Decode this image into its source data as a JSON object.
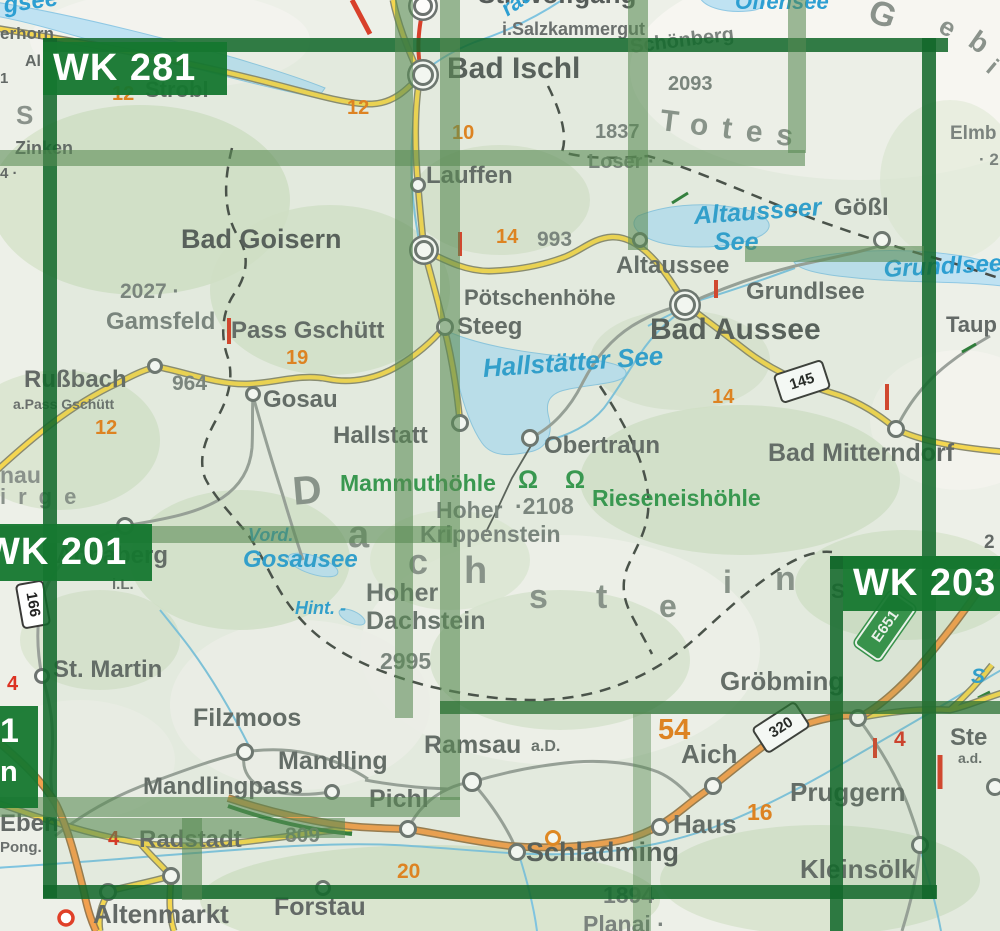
{
  "colors": {
    "sheet_green": "#157731",
    "overlay_green": "#588a52",
    "road_yellow": "#f4d650",
    "road_orange": "#f2a04e",
    "water_blue": "#2d9fd2",
    "lake_fill": "#bfe2f2",
    "town_gray": "#636966",
    "route_orange": "#e6801c",
    "mark_red": "#dc3222",
    "cave_green": "#35974e"
  },
  "sheets": [
    {
      "t": "WK 281"
    },
    {
      "t": "WK 201"
    },
    {
      "t": "WK 203"
    }
  ],
  "partial_sheet": {
    "l1": "1",
    "l2": "n"
  },
  "labels": [
    {
      "n": "wolfgangsee-frag",
      "t": "gsee",
      "x": 2,
      "y": -6,
      "s": 24,
      "c": "water",
      "r": -8
    },
    {
      "n": "st-wolfgang-frag",
      "t": "St. Wolfgang",
      "x": 478,
      "y": -19,
      "s": 26,
      "c": "town-lg"
    },
    {
      "n": "salzkammergut",
      "t": "i.Salzkammergut",
      "x": 502,
      "y": 20,
      "s": 18,
      "c": "small"
    },
    {
      "n": "zwoelferhorn-frag",
      "t": "erhorn",
      "x": 0,
      "y": 25,
      "s": 17,
      "c": "town"
    },
    {
      "n": "frag-al",
      "t": "Al",
      "x": 25,
      "y": 54,
      "s": 16,
      "c": "town"
    },
    {
      "n": "frag-1",
      "t": "1",
      "x": 0,
      "y": 71,
      "s": 15,
      "c": "town"
    },
    {
      "n": "frag-s",
      "t": "S",
      "x": 16,
      "y": 102,
      "s": 26,
      "c": "region"
    },
    {
      "n": "zinken",
      "t": "Zinken",
      "x": 15,
      "y": 139,
      "s": 18,
      "c": "town"
    },
    {
      "n": "frag-4",
      "t": "4 ·",
      "x": 0,
      "y": 166,
      "s": 15,
      "c": "town"
    },
    {
      "n": "route-12-strobl",
      "t": "12",
      "x": 112,
      "y": 84,
      "s": 20,
      "c": "route"
    },
    {
      "n": "strobl",
      "t": "Strobl",
      "x": 145,
      "y": 79,
      "s": 22,
      "c": "town"
    },
    {
      "n": "route-12-ischl",
      "t": "12",
      "x": 347,
      "y": 98,
      "s": 20,
      "c": "route"
    },
    {
      "n": "bad-ischl",
      "t": "Bad Ischl",
      "x": 447,
      "y": 54,
      "s": 30,
      "c": "town-lg"
    },
    {
      "n": "traun-frag",
      "t": "raun",
      "x": 497,
      "y": 2,
      "s": 22,
      "c": "water",
      "r": -35
    },
    {
      "n": "offensee",
      "t": "Offensee",
      "x": 735,
      "y": -9,
      "s": 22,
      "c": "water"
    },
    {
      "n": "schoenberg",
      "t": "Schönberg",
      "x": 629,
      "y": 37,
      "s": 20,
      "c": "peak",
      "r": -7
    },
    {
      "n": "schoenberg-elev",
      "t": "2093",
      "x": 668,
      "y": 74,
      "s": 20,
      "c": "peak"
    },
    {
      "n": "loser-elev",
      "t": "1837",
      "x": 595,
      "y": 122,
      "s": 20,
      "c": "peak"
    },
    {
      "n": "loser",
      "t": "Loser ·",
      "x": 588,
      "y": 152,
      "s": 20,
      "c": "peak"
    },
    {
      "n": "totes",
      "t": "Totes",
      "x": 662,
      "y": 106,
      "s": 30,
      "c": "region",
      "r": 7,
      "ls": 14
    },
    {
      "n": "gebirge-g",
      "t": "G",
      "x": 876,
      "y": -6,
      "s": 34,
      "c": "region",
      "r": 20
    },
    {
      "n": "gebirge-e",
      "t": "e",
      "x": 948,
      "y": 12,
      "s": 26,
      "c": "region",
      "r": 30
    },
    {
      "n": "gebirge-b",
      "t": "b",
      "x": 980,
      "y": 26,
      "s": 28,
      "c": "region",
      "r": 35
    },
    {
      "n": "gebirge-i",
      "t": "i",
      "x": 997,
      "y": 56,
      "s": 24,
      "c": "region",
      "r": 40
    },
    {
      "n": "elmberg-frag",
      "t": "Elmb",
      "x": 950,
      "y": 124,
      "s": 19,
      "c": "peak"
    },
    {
      "n": "elm-elev-frag",
      "t": "· 2",
      "x": 979,
      "y": 151,
      "s": 17,
      "c": "peak"
    },
    {
      "n": "route-10",
      "t": "10",
      "x": 452,
      "y": 123,
      "s": 20,
      "c": "route"
    },
    {
      "n": "lauffen",
      "t": "Lauffen",
      "x": 426,
      "y": 164,
      "s": 24,
      "c": "town"
    },
    {
      "n": "bad-goisern",
      "t": "Bad Goisern",
      "x": 181,
      "y": 226,
      "s": 27,
      "c": "town-lg"
    },
    {
      "n": "route-14-a",
      "t": "14",
      "x": 496,
      "y": 227,
      "s": 20,
      "c": "route"
    },
    {
      "n": "poetschen-elev",
      "t": "993",
      "x": 537,
      "y": 229,
      "s": 21,
      "c": "peak"
    },
    {
      "n": "altausseer-see-1",
      "t": "Altausseer",
      "x": 693,
      "y": 204,
      "s": 25,
      "c": "water",
      "r": -4
    },
    {
      "n": "altausseer-see-2",
      "t": "See",
      "x": 714,
      "y": 230,
      "s": 25,
      "c": "water"
    },
    {
      "n": "goessl",
      "t": "Gößl",
      "x": 834,
      "y": 196,
      "s": 24,
      "c": "town"
    },
    {
      "n": "poetschenhoehe",
      "t": "Pötschenhöhe",
      "x": 464,
      "y": 287,
      "s": 22,
      "c": "town"
    },
    {
      "n": "steeg",
      "t": "Steeg",
      "x": 457,
      "y": 315,
      "s": 24,
      "c": "town"
    },
    {
      "n": "altaussee",
      "t": "Altaussee",
      "x": 616,
      "y": 254,
      "s": 24,
      "c": "town"
    },
    {
      "n": "grundlsee-town",
      "t": "Grundlsee",
      "x": 746,
      "y": 280,
      "s": 24,
      "c": "town"
    },
    {
      "n": "grundlsee-lake",
      "t": "Grundlsee",
      "x": 883,
      "y": 258,
      "s": 24,
      "c": "water",
      "r": -3
    },
    {
      "n": "bad-aussee",
      "t": "Bad Aussee",
      "x": 650,
      "y": 315,
      "s": 30,
      "c": "town-lg"
    },
    {
      "n": "tauplitz-frag",
      "t": "Taup",
      "x": 946,
      "y": 314,
      "s": 22,
      "c": "town"
    },
    {
      "n": "gamsfeld-elev",
      "t": "2027 ·",
      "x": 120,
      "y": 281,
      "s": 21,
      "c": "peak"
    },
    {
      "n": "gamsfeld",
      "t": "Gamsfeld",
      "x": 106,
      "y": 310,
      "s": 24,
      "c": "peak"
    },
    {
      "n": "pass-gschuett",
      "t": "Pass Gschütt",
      "x": 231,
      "y": 319,
      "s": 24,
      "c": "town"
    },
    {
      "n": "route-19",
      "t": "19",
      "x": 286,
      "y": 348,
      "s": 20,
      "c": "route"
    },
    {
      "n": "russbach",
      "t": "Rußbach",
      "x": 24,
      "y": 368,
      "s": 24,
      "c": "town"
    },
    {
      "n": "russbach-elev",
      "t": "964",
      "x": 172,
      "y": 373,
      "s": 21,
      "c": "peak"
    },
    {
      "n": "a-pass-gschuett",
      "t": "a.Pass Gschütt",
      "x": 13,
      "y": 397,
      "s": 14,
      "c": "small"
    },
    {
      "n": "route-12-gschuett",
      "t": "12",
      "x": 95,
      "y": 418,
      "s": 20,
      "c": "route"
    },
    {
      "n": "gosau",
      "t": "Gosau",
      "x": 263,
      "y": 388,
      "s": 24,
      "c": "town"
    },
    {
      "n": "hallstaetter-see",
      "t": "Hallstätter See",
      "x": 482,
      "y": 355,
      "s": 26,
      "c": "water",
      "r": -4
    },
    {
      "n": "hallstatt",
      "t": "Hallstatt",
      "x": 333,
      "y": 424,
      "s": 24,
      "c": "town"
    },
    {
      "n": "obertraun",
      "t": "Obertraun",
      "x": 544,
      "y": 434,
      "s": 24,
      "c": "town"
    },
    {
      "n": "bad-mitterndorf",
      "t": "Bad Mitterndorf",
      "x": 768,
      "y": 441,
      "s": 25,
      "c": "town"
    },
    {
      "n": "route-14-b",
      "t": "14",
      "x": 712,
      "y": 387,
      "s": 20,
      "c": "route"
    },
    {
      "n": "mammuthoehle",
      "t": "Mammuthöhle",
      "x": 340,
      "y": 472,
      "s": 23,
      "c": "cave"
    },
    {
      "n": "cave-symbols",
      "t": "Ω Ω",
      "x": 518,
      "y": 468,
      "s": 25,
      "c": "cave",
      "ls": 10
    },
    {
      "n": "rieseneishoehle",
      "t": "Rieseneishöhle",
      "x": 592,
      "y": 487,
      "s": 23,
      "c": "cave"
    },
    {
      "n": "krippenstein-hoher",
      "t": "Hoher",
      "x": 436,
      "y": 499,
      "s": 23,
      "c": "peak"
    },
    {
      "n": "krippenstein-elev",
      "t": "·2108",
      "x": 515,
      "y": 495,
      "s": 23,
      "c": "peak"
    },
    {
      "n": "krippenstein",
      "t": "Krippenstein",
      "x": 420,
      "y": 523,
      "s": 23,
      "c": "peak"
    },
    {
      "n": "frag-nau",
      "t": "nau",
      "x": 0,
      "y": 464,
      "s": 23,
      "c": "region"
    },
    {
      "n": "frag-irge",
      "t": "irge",
      "x": 0,
      "y": 486,
      "s": 22,
      "c": "region",
      "ls": 12
    },
    {
      "n": "gosausee-vord",
      "t": "Vord.",
      "x": 248,
      "y": 526,
      "s": 18,
      "c": "water"
    },
    {
      "n": "gosausee",
      "t": "Gosausee",
      "x": 243,
      "y": 548,
      "s": 24,
      "c": "water"
    },
    {
      "n": "gosausee-hint",
      "t": "Hint. -",
      "x": 295,
      "y": 599,
      "s": 18,
      "c": "water"
    },
    {
      "n": "annaberg",
      "t": "Annaberg",
      "x": 56,
      "y": 544,
      "s": 24,
      "c": "town"
    },
    {
      "n": "annaberg-il",
      "t": "i.L.",
      "x": 112,
      "y": 577,
      "s": 15,
      "c": "small"
    },
    {
      "n": "dachstein-d",
      "t": "D",
      "x": 291,
      "y": 472,
      "s": 40,
      "c": "region",
      "r": -5
    },
    {
      "n": "dachstein-a",
      "t": "a",
      "x": 348,
      "y": 516,
      "s": 38,
      "c": "region"
    },
    {
      "n": "dachstein-c",
      "t": "c",
      "x": 408,
      "y": 544,
      "s": 36,
      "c": "region"
    },
    {
      "n": "dachstein-h",
      "t": "h",
      "x": 464,
      "y": 552,
      "s": 38,
      "c": "region"
    },
    {
      "n": "dachstein-s",
      "t": "s",
      "x": 529,
      "y": 580,
      "s": 34,
      "c": "region"
    },
    {
      "n": "dachstein-t",
      "t": "t",
      "x": 596,
      "y": 580,
      "s": 34,
      "c": "region"
    },
    {
      "n": "dachstein-e",
      "t": "e",
      "x": 659,
      "y": 590,
      "s": 32,
      "c": "region"
    },
    {
      "n": "dachstein-i",
      "t": "i",
      "x": 723,
      "y": 566,
      "s": 32,
      "c": "region"
    },
    {
      "n": "dachstein-n",
      "t": "n",
      "x": 775,
      "y": 562,
      "s": 34,
      "c": "region"
    },
    {
      "n": "hoher-dachstein-1",
      "t": "Hoher",
      "x": 366,
      "y": 581,
      "s": 25,
      "c": "peak-b"
    },
    {
      "n": "hoher-dachstein-2",
      "t": "Dachstein",
      "x": 366,
      "y": 609,
      "s": 25,
      "c": "peak-b"
    },
    {
      "n": "dachstein-elev",
      "t": "2995",
      "x": 380,
      "y": 650,
      "s": 23,
      "c": "peak"
    },
    {
      "n": "st-martin",
      "t": "St. Martin",
      "x": 53,
      "y": 658,
      "s": 24,
      "c": "town"
    },
    {
      "n": "red-4-a",
      "t": "4",
      "x": 7,
      "y": 674,
      "s": 20,
      "c": "red"
    },
    {
      "n": "filzmoos",
      "t": "Filzmoos",
      "x": 193,
      "y": 706,
      "s": 25,
      "c": "town"
    },
    {
      "n": "groebming",
      "t": "Gröbming",
      "x": 720,
      "y": 668,
      "s": 26,
      "c": "town"
    },
    {
      "n": "route-54",
      "t": "54",
      "x": 658,
      "y": 716,
      "s": 29,
      "c": "route"
    },
    {
      "n": "frag-2",
      "t": "2",
      "x": 984,
      "y": 533,
      "s": 19,
      "c": "town"
    },
    {
      "n": "frag-s2",
      "t": "S",
      "x": 831,
      "y": 581,
      "s": 21,
      "c": "town"
    },
    {
      "n": "mandling",
      "t": "Mandling",
      "x": 278,
      "y": 749,
      "s": 25,
      "c": "town"
    },
    {
      "n": "mandlingpass",
      "t": "Mandlingpass",
      "x": 143,
      "y": 775,
      "s": 24,
      "c": "town"
    },
    {
      "n": "pichl",
      "t": "Pichl",
      "x": 369,
      "y": 787,
      "s": 25,
      "c": "town"
    },
    {
      "n": "ramsau",
      "t": "Ramsau",
      "x": 424,
      "y": 733,
      "s": 25,
      "c": "town"
    },
    {
      "n": "ramsau-ad",
      "t": "a.D.",
      "x": 531,
      "y": 739,
      "s": 16,
      "c": "small"
    },
    {
      "n": "radstadt-elev",
      "t": "809",
      "x": 285,
      "y": 825,
      "s": 21,
      "c": "peak"
    },
    {
      "n": "radstadt",
      "t": "Radstadt",
      "x": 139,
      "y": 828,
      "s": 24,
      "c": "town"
    },
    {
      "n": "red-4-b",
      "t": "4",
      "x": 108,
      "y": 829,
      "s": 20,
      "c": "red"
    },
    {
      "n": "eben",
      "t": "Eben",
      "x": 0,
      "y": 812,
      "s": 24,
      "c": "town"
    },
    {
      "n": "eben-pongau",
      "t": "Pong.",
      "x": 0,
      "y": 840,
      "s": 15,
      "c": "small"
    },
    {
      "n": "altenmarkt",
      "t": "Altenmarkt",
      "x": 93,
      "y": 901,
      "s": 26,
      "c": "town"
    },
    {
      "n": "forstau",
      "t": "Forstau",
      "x": 274,
      "y": 895,
      "s": 25,
      "c": "town"
    },
    {
      "n": "route-20",
      "t": "20",
      "x": 397,
      "y": 861,
      "s": 21,
      "c": "route"
    },
    {
      "n": "schladming",
      "t": "Schladming",
      "x": 526,
      "y": 839,
      "s": 27,
      "c": "town-lg"
    },
    {
      "n": "planai-elev",
      "t": "1894",
      "x": 603,
      "y": 884,
      "s": 23,
      "c": "peak"
    },
    {
      "n": "planai",
      "t": "Planai ·",
      "x": 583,
      "y": 913,
      "s": 23,
      "c": "peak"
    },
    {
      "n": "haus",
      "t": "Haus",
      "x": 673,
      "y": 811,
      "s": 26,
      "c": "town"
    },
    {
      "n": "aich",
      "t": "Aich",
      "x": 681,
      "y": 741,
      "s": 26,
      "c": "town"
    },
    {
      "n": "route-16",
      "t": "16",
      "x": 747,
      "y": 801,
      "s": 23,
      "c": "route"
    },
    {
      "n": "pruggern",
      "t": "Pruggern",
      "x": 790,
      "y": 779,
      "s": 26,
      "c": "town"
    },
    {
      "n": "kleinsoelk",
      "t": "Kleinsölk",
      "x": 800,
      "y": 856,
      "s": 26,
      "c": "town"
    },
    {
      "n": "stein-frag",
      "t": "Ste",
      "x": 950,
      "y": 726,
      "s": 24,
      "c": "town"
    },
    {
      "n": "stein-ad",
      "t": "a.d.",
      "x": 958,
      "y": 751,
      "s": 14,
      "c": "small"
    },
    {
      "n": "red-4-c",
      "t": "4",
      "x": 894,
      "y": 729,
      "s": 21,
      "c": "red"
    },
    {
      "n": "water-s-frag",
      "t": "S",
      "x": 971,
      "y": 666,
      "s": 21,
      "c": "water"
    }
  ],
  "markers": [
    {
      "n": "st-wolfgang",
      "x": 423,
      "y": 6,
      "r": 10,
      "k": "double"
    },
    {
      "n": "bad-ischl",
      "x": 423,
      "y": 75,
      "r": 11,
      "k": "double"
    },
    {
      "n": "lauffen",
      "x": 418,
      "y": 185,
      "r": 8,
      "k": "town"
    },
    {
      "n": "bad-goisern",
      "x": 424,
      "y": 250,
      "r": 10,
      "k": "double"
    },
    {
      "n": "goessl",
      "x": 882,
      "y": 240,
      "r": 9,
      "k": "town"
    },
    {
      "n": "altaussee",
      "x": 640,
      "y": 240,
      "r": 8,
      "k": "town"
    },
    {
      "n": "bad-aussee",
      "x": 685,
      "y": 305,
      "r": 11,
      "k": "double"
    },
    {
      "n": "steeg",
      "x": 445,
      "y": 327,
      "r": 9,
      "k": "town"
    },
    {
      "n": "hallstatt",
      "x": 460,
      "y": 423,
      "r": 9,
      "k": "town"
    },
    {
      "n": "obertraun",
      "x": 530,
      "y": 438,
      "r": 9,
      "k": "town"
    },
    {
      "n": "bad-mitterndorf",
      "x": 896,
      "y": 429,
      "r": 9,
      "k": "town"
    },
    {
      "n": "gosau",
      "x": 253,
      "y": 394,
      "r": 8,
      "k": "town"
    },
    {
      "n": "russbach",
      "x": 155,
      "y": 366,
      "r": 8,
      "k": "town"
    },
    {
      "n": "annaberg",
      "x": 125,
      "y": 526,
      "r": 9,
      "k": "town"
    },
    {
      "n": "st-martin",
      "x": 42,
      "y": 676,
      "r": 8,
      "k": "town"
    },
    {
      "n": "filzmoos",
      "x": 245,
      "y": 752,
      "r": 9,
      "k": "town"
    },
    {
      "n": "mandlingpass",
      "x": 332,
      "y": 792,
      "r": 8,
      "k": "town"
    },
    {
      "n": "radstadt",
      "x": 171,
      "y": 876,
      "r": 9,
      "k": "town"
    },
    {
      "n": "altenmarkt",
      "x": 108,
      "y": 892,
      "r": 9,
      "k": "town"
    },
    {
      "n": "forstau",
      "x": 323,
      "y": 888,
      "r": 8,
      "k": "town"
    },
    {
      "n": "pichl",
      "x": 408,
      "y": 829,
      "r": 9,
      "k": "town"
    },
    {
      "n": "ramsau",
      "x": 472,
      "y": 782,
      "r": 10,
      "k": "town"
    },
    {
      "n": "schladming",
      "x": 517,
      "y": 852,
      "r": 9,
      "k": "town"
    },
    {
      "n": "planai-resort",
      "x": 553,
      "y": 838,
      "r": 8,
      "k": "resort"
    },
    {
      "n": "haus",
      "x": 660,
      "y": 827,
      "r": 9,
      "k": "town"
    },
    {
      "n": "aich",
      "x": 713,
      "y": 786,
      "r": 9,
      "k": "town"
    },
    {
      "n": "groebming",
      "x": 858,
      "y": 718,
      "r": 9,
      "k": "town"
    },
    {
      "n": "kleinsoelk",
      "x": 920,
      "y": 845,
      "r": 9,
      "k": "town"
    },
    {
      "n": "edge-town",
      "x": 995,
      "y": 787,
      "r": 9,
      "k": "town"
    }
  ],
  "shields": [
    {
      "n": "road-145",
      "t": "145",
      "x": 776,
      "y": 366,
      "w": 48,
      "h": 27,
      "r": -18
    },
    {
      "n": "road-320",
      "t": "320",
      "x": 755,
      "y": 712,
      "w": 48,
      "h": 27,
      "r": -33
    },
    {
      "n": "road-166",
      "t": "166",
      "x": 10,
      "y": 590,
      "w": 42,
      "h": 25,
      "r": 80
    },
    {
      "n": "road-e651",
      "t": "E651",
      "x": 852,
      "y": 610,
      "w": 62,
      "h": 28,
      "r": -55,
      "e": true
    }
  ]
}
